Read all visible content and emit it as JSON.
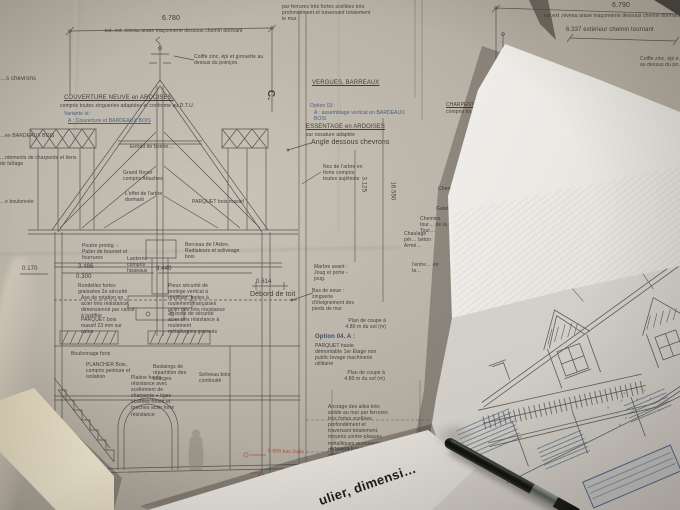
{
  "photo": {
    "description": "Overhead photograph of French architectural blueprint sheets: a large roof-structure section drawing, a curled rolled plan showing a house elevation with two dormers, a black pen and a rolled paper tube"
  },
  "colors": {
    "paper_left": "#b6afa4",
    "paper_white": "#efede9",
    "table": "#4e4b45",
    "ink": "#45443f",
    "annotation_blue": "#46607a",
    "mark_red": "#a8473c",
    "pen_black": "#161815",
    "tube_beige": "#d5c8ad"
  },
  "left_sheet": {
    "dim_top": {
      "value": "6.780",
      "label": "est. ext. niveau arase maçonnerie dessous chemin dormant"
    },
    "dims": {
      "d0170": "0.170",
      "d3486": "3.486",
      "d0300": "0.300",
      "d3440": "3.440",
      "d0614": "0.614",
      "d3125": "3.125",
      "d16550": "16.550"
    },
    "marks": {
      "section": "C.",
      "red_level": "6.658 bas Dalle",
      "red_level2": "6.125"
    },
    "notes": {
      "ferrures": "par ferrures très fortes scellées très profondément et traversant totalement le mur.",
      "coiffe": "Coiffe zinc, épi et girouette au dessus du poinçon.",
      "couverture_title": "COUVERTURE NEUVE en ARDOISES,",
      "couverture_sub": "compris toutes zingueries adaptées et conforme au D.T.U.",
      "variante": "Variante id :",
      "variante_a": "A : Couverture et BARDEAUX BOIS",
      "vergues": "VERGUES, BARREAUX",
      "option03": "Option 03 :",
      "option03_a": "A : assemblage vertical en BARDEAUX BOIS",
      "essentage": "ESSENTAGE en ARDOISES",
      "essentage_sub": "sur ossature adaptée",
      "angle": "Angle dessous chevrons",
      "nez": "Nez de l'arbre en fonte compris toutes sujétions",
      "entrait": "Entrait de bonne…",
      "grand_noyer": "Grand Noyer compris Attaches",
      "effet": "L'effet de l'arbre dormant",
      "parquet_droit": "PARQUET bois massif",
      "lanterne": "Lanterne compris hisseaux",
      "berceau": "Berceau de l'Arbre, Radiateurs et soliveage bois",
      "poutre": "Poutre protég. - Palier de bourset et fourrures",
      "rondelles": "Rondelles fortes graissées 2e sécurité",
      "axe": "Axe de rotation en acier très résistance, dimensionné par calcul à justifier",
      "parquet_cales": "PARQUET bois massif 23 mm sur cales",
      "pieux": "Pieux sécurité de protège vertical à réutiliser, boites à roulement françaises acier très très résistance",
      "boite2": "2e boite de sécurité acier très résistance à roulement métallurgies graissés",
      "boulonnage": "Boulonnage forts",
      "plancher": "PLANCHER Bois, compris peinture et isolation",
      "bastaings": "Bastaings de répartition des charges",
      "platine": "Platine haute résistance avec scellement de charpente + tiges scellées fortes et broches acier forte résistance",
      "soliveau": "Soliveau bois continuité",
      "marbre": "Marbre avant : Joug et porte - joug.",
      "bas_noue": "Bas de noue : zinguerie d'éloignement des pieds de mur",
      "debord": "Débord de toit",
      "coupe": "Plan de coupe à 4.80 m du sol (m)",
      "option04": "Option 04. A :",
      "option04_text": "PARQUET haute démontable 1er Étage non public levage machinerie utilitaire",
      "ancrage": "Ancrage des ailes très solide au mur par ferrures très fortes scellées profondément et traversant totalement, moyens contre-plaques métalliques recouvertes de bois dur anti-condensations",
      "ancrage2": "Ancrage très forts : équerres fortes scellées ou étriers, de triangle, pied, campanile et levage…",
      "charpente1": "CHARPENTE comp…",
      "charpente2": "compris toutes suj…",
      "edge_chevrons": "…s chevrons",
      "edge_bardeaux": "…en BARDEAUX BOIS",
      "edge_charpente": "…ntements de charpente et liens de faîtage",
      "edge_boulonnee": "…e boulonnée"
    }
  },
  "right_sheet": {
    "dim_6790": "6.790",
    "dim_6790_label": "ext.ext .niveau arase maçonnerie dessous chemin dormant",
    "dim_6337": "6.337  extérieur chemin tournant",
    "coiffe_frag": "Coiffe zinc, épi e… au dessus du po…",
    "frags": {
      "chemin": "Chemin…",
      "galets": "Galets ou…",
      "tournant": "Chemins tour… de la Tour…",
      "chaulage": "Chaulage pér… béton Armé…",
      "entre": "l'entre… en la…"
    }
  },
  "rolled_sheet": {
    "curl_text": "ulier, dimensi…"
  }
}
